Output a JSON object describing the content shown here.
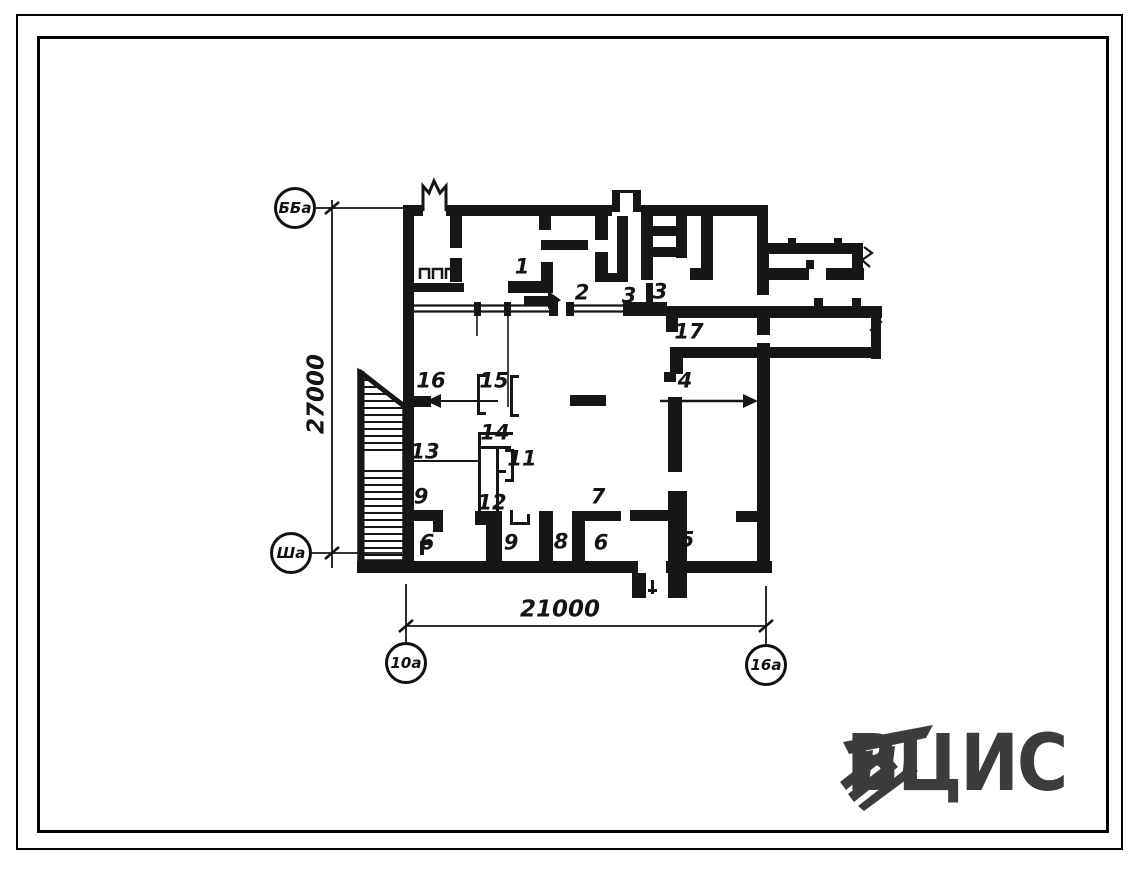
{
  "page": {
    "background": "#ffffff",
    "ink": "#141414"
  },
  "plan": {
    "axis_markers": [
      {
        "id": "left-top",
        "label": "ББа"
      },
      {
        "id": "left-bottom",
        "label": "Ша"
      },
      {
        "id": "bottom-left",
        "label": "10а"
      },
      {
        "id": "bottom-right",
        "label": "16а"
      }
    ],
    "dimensions": [
      {
        "id": "vertical",
        "value": "27000"
      },
      {
        "id": "horizontal",
        "value": "21000"
      }
    ],
    "room_labels": [
      {
        "text": "1"
      },
      {
        "text": "2"
      },
      {
        "text": "3"
      },
      {
        "text": "3"
      },
      {
        "text": "17"
      },
      {
        "text": "4"
      },
      {
        "text": "16"
      },
      {
        "text": "15"
      },
      {
        "text": "14"
      },
      {
        "text": "11"
      },
      {
        "text": "13"
      },
      {
        "text": "9"
      },
      {
        "text": "12"
      },
      {
        "text": "6"
      },
      {
        "text": "9"
      },
      {
        "text": "8"
      },
      {
        "text": "6"
      },
      {
        "text": "7"
      },
      {
        "text": "5"
      }
    ]
  },
  "logo": {
    "text": "ВЦИС",
    "color": "#3c3c3f"
  }
}
